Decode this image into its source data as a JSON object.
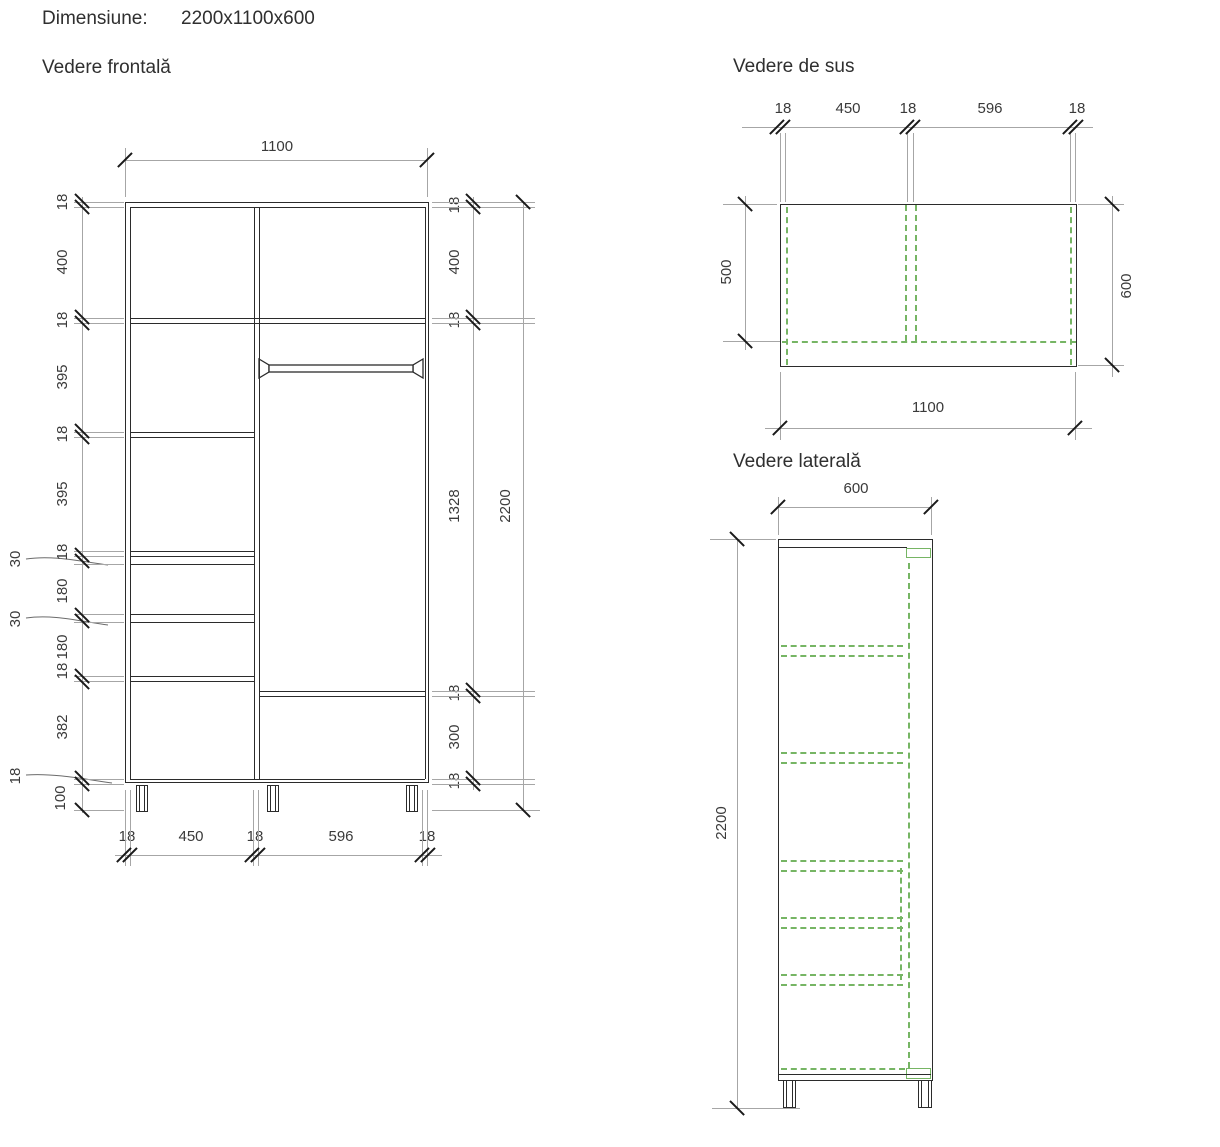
{
  "header": {
    "label": "Dimensiune:",
    "value": "2200x1100x600"
  },
  "front_view": {
    "title": "Vedere frontală",
    "width_total": "1100",
    "left_chain": [
      "18",
      "400",
      "18",
      "395",
      "18",
      "395",
      "18",
      "180",
      "180",
      "18",
      "382"
    ],
    "left_gap_top": "30",
    "left_gap_bottom": "30",
    "left_bottom_panel": "18",
    "left_legs": "100",
    "right_chain": [
      "18",
      "400",
      "18",
      "1328",
      "18",
      "300",
      "18"
    ],
    "height_total": "2200",
    "bottom_chain": [
      "18",
      "450",
      "18",
      "596",
      "18"
    ]
  },
  "top_view": {
    "title": "Vedere de sus",
    "top_chain": [
      "18",
      "450",
      "18",
      "596",
      "18"
    ],
    "depth_partial": "500",
    "depth_total": "600",
    "width_total": "1100"
  },
  "side_view": {
    "title": "Vedere laterală",
    "depth_total": "600",
    "height_total": "2200"
  },
  "colors": {
    "drawing_line": "#2b2b2b",
    "extension_gray": "#a6a6a6",
    "hidden_line_green": "#76b564",
    "dim_text": "#3a3a3a"
  }
}
